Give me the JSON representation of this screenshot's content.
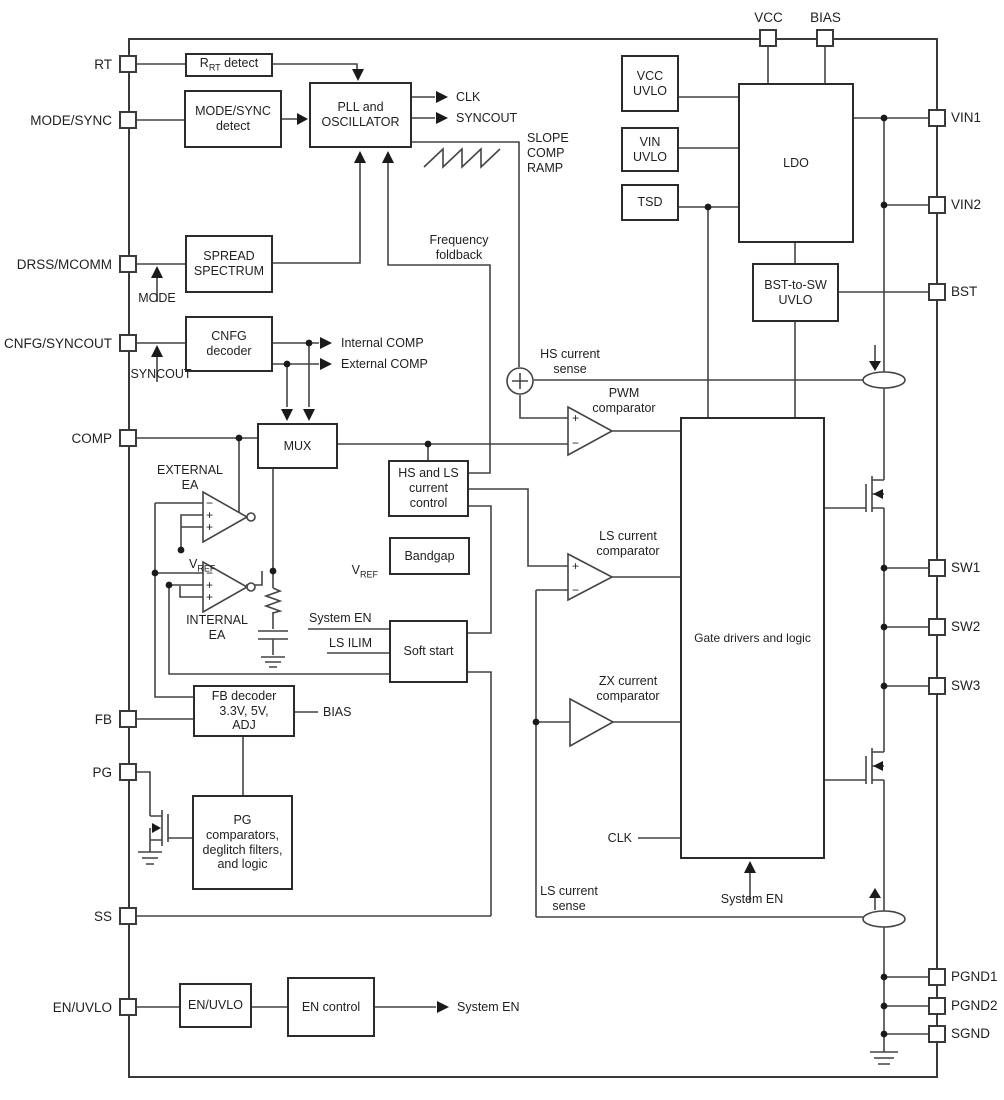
{
  "glyphs": {
    "plus": "+",
    "minus": "−"
  },
  "pins": {
    "rt": "RT",
    "mode_sync": "MODE/SYNC",
    "drss_mcomm": "DRSS/MCOMM",
    "cnfg_syncout": "CNFG/SYNCOUT",
    "comp": "COMP",
    "fb": "FB",
    "pg": "PG",
    "ss": "SS",
    "en_uvlo": "EN/UVLO",
    "vcc": "VCC",
    "bias": "BIAS",
    "vin1": "VIN1",
    "vin2": "VIN2",
    "bst": "BST",
    "sw1": "SW1",
    "sw2": "SW2",
    "sw3": "SW3",
    "pgnd1": "PGND1",
    "pgnd2": "PGND2",
    "sgnd": "SGND"
  },
  "blocks": {
    "rrt_pre": "R",
    "rrt_sub": "RT",
    "rrt_post": " detect",
    "mode_sync_detect": "MODE/SYNC\ndetect",
    "pll_osc": "PLL and\nOSCILLATOR",
    "spread_spectrum": "SPREAD\nSPECTRUM",
    "cnfg_decoder": "CNFG\ndecoder",
    "mux": "MUX",
    "hs_ls_current_control": "HS and LS\ncurrent\ncontrol",
    "bandgap": "Bandgap",
    "soft_start": "Soft start",
    "fb_decoder": "FB decoder\n3.3V, 5V,\nADJ",
    "pg_block": "PG\ncomparators,\ndeglitch filters,\nand logic",
    "en_uvlo": "EN/UVLO",
    "en_control": "EN control",
    "vcc_uvlo": "VCC\nUVLO",
    "vin_uvlo": "VIN\nUVLO",
    "tsd": "TSD",
    "ldo": "LDO",
    "bst_to_sw_uvlo": "BST-to-SW\nUVLO",
    "gate_drivers": "Gate drivers and logic"
  },
  "signals": {
    "clk_out": "CLK",
    "syncout_out": "SYNCOUT",
    "slope_comp_ramp": "SLOPE\nCOMP\nRAMP",
    "frequency_foldback": "Frequency\nfoldback",
    "mode": "MODE",
    "syncout_in": "SYNCOUT",
    "internal_comp": "Internal COMP",
    "external_comp": "External COMP",
    "external_ea": "EXTERNAL\nEA",
    "internal_ea": "INTERNAL\nEA",
    "vref_base": "V",
    "vref_sub": "REF",
    "hs_current_sense": "HS current\nsense",
    "pwm_comparator": "PWM\ncomparator",
    "ls_current_comparator": "LS current\ncomparator",
    "zx_current_comparator": "ZX current\ncomparator",
    "system_en": "System EN",
    "ls_ilim": "LS ILIM",
    "bias": "BIAS",
    "clk_in": "CLK",
    "ls_current_sense": "LS current\nsense"
  }
}
